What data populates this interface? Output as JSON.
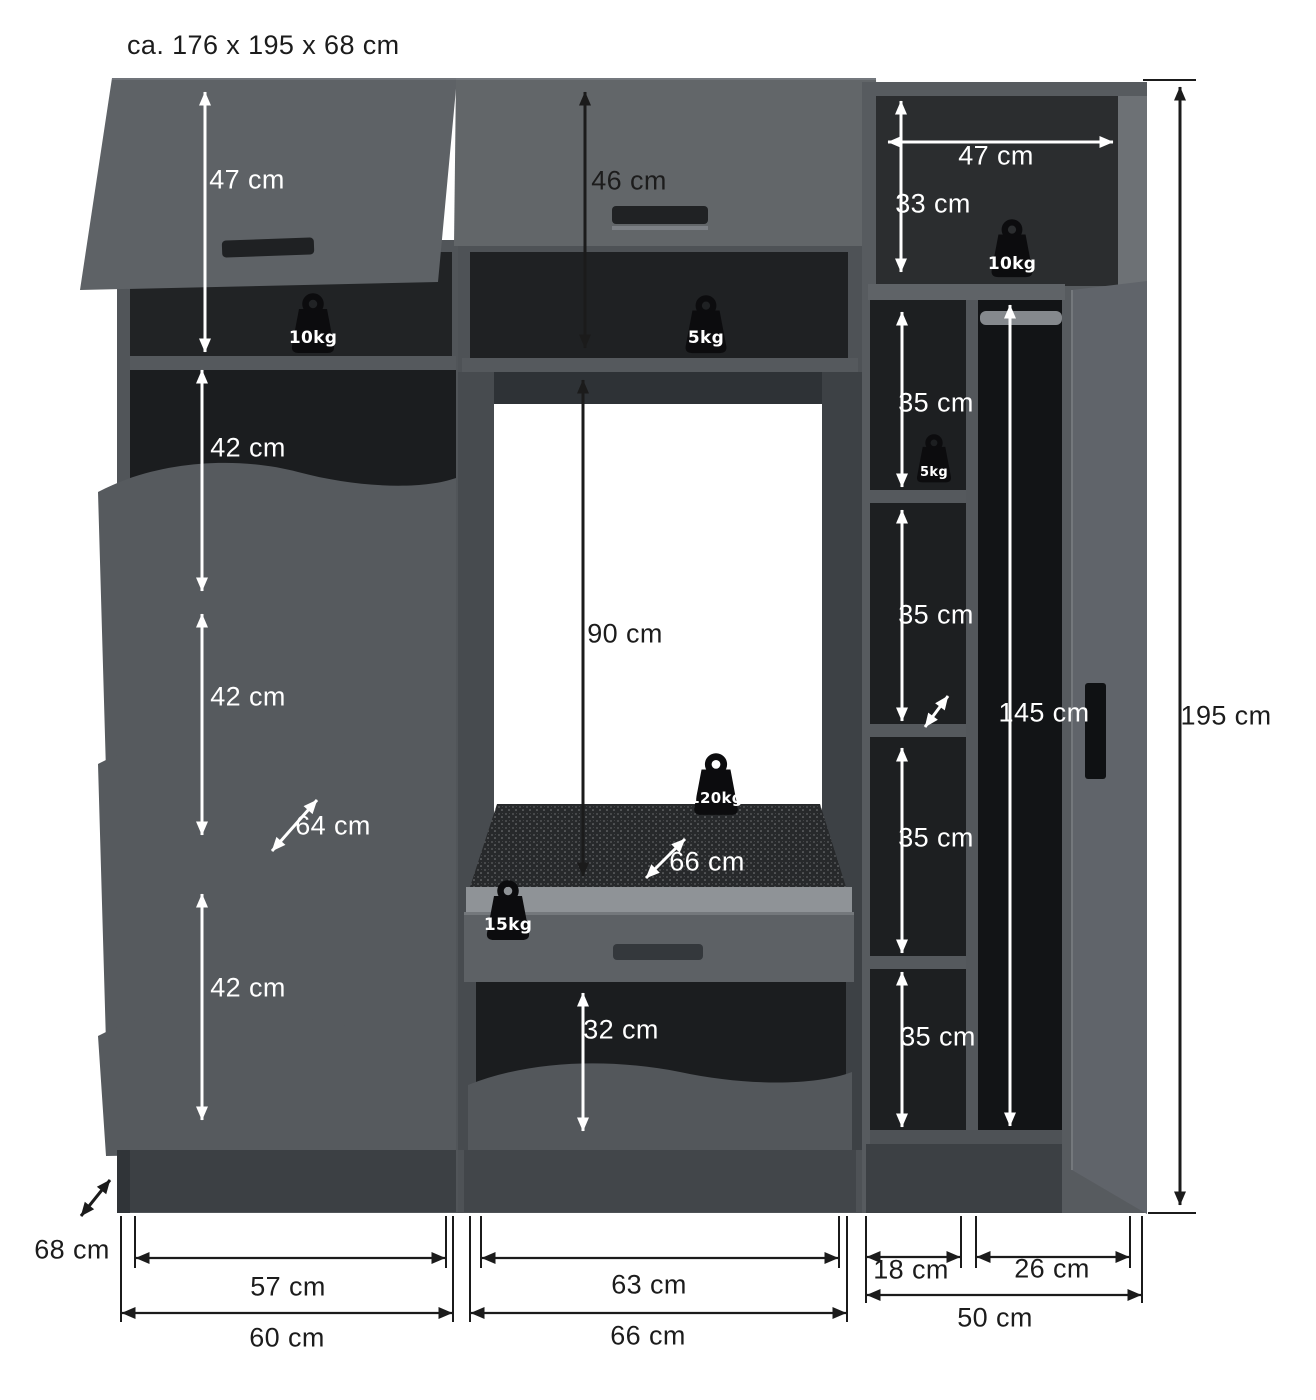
{
  "title": "ca. 176 x 195 x 68 cm",
  "colors": {
    "background": "#ffffff",
    "furniture_front": "#5b5f63",
    "furniture_side": "#45494d",
    "interior_dark": "#1d1f21",
    "dimension_dark": "#1b1b1b",
    "dimension_light": "#ffffff",
    "weight_icon": "#0c0c0e"
  },
  "left_unit": {
    "flap_height": "47 cm",
    "flap_load": "10kg",
    "compartment_1": "42 cm",
    "compartment_2": "42 cm",
    "compartment_3": "42 cm",
    "diagonal_depth": "64 cm",
    "inner_width": "57 cm",
    "outer_width": "60 cm"
  },
  "middle_unit": {
    "flap_height": "46 cm",
    "top_shelf_load": "5kg",
    "opening_height": "90 cm",
    "seat_load": "120kg",
    "seat_depth": "66 cm",
    "drawer_load": "15kg",
    "bottom_opening": "32 cm",
    "inner_width": "63 cm",
    "outer_width": "66 cm"
  },
  "right_unit": {
    "top_width": "47 cm",
    "top_height": "33 cm",
    "top_load": "10kg",
    "compartment_1": "35 cm",
    "compartment_1_load": "5kg",
    "compartment_2": "35 cm",
    "compartment_3": "35 cm",
    "compartment_4": "35 cm",
    "hanging_height": "145 cm",
    "shelf_col_width": "18 cm",
    "wardrobe_col_width": "26 cm",
    "outer_width": "50 cm"
  },
  "overall": {
    "depth": "68 cm",
    "height": "195 cm"
  }
}
